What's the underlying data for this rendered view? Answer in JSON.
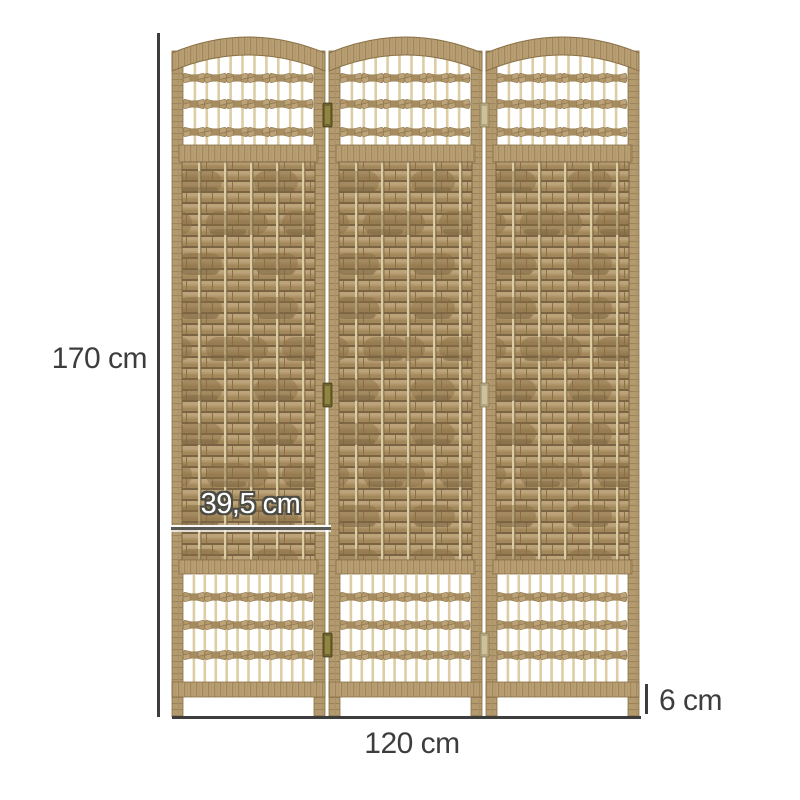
{
  "figure": {
    "type": "product-dimension-diagram",
    "subject": "three-panel woven folding room divider",
    "panel_count": 3,
    "colors": {
      "background": "#ffffff",
      "wood_frame": "#b79d72",
      "wood_dark": "#8a7046",
      "weave_body": "#b09669",
      "weave_gap": "#7a6443",
      "spindle": "#dccda4",
      "hinge_brass": "#6e652e",
      "hinge_tan": "#b3a67f",
      "dimension": "#3d3d3d"
    }
  },
  "labels": {
    "height": "170 cm",
    "panel_width": "39,5 cm",
    "total_width": "120 cm",
    "foot_height": "6 cm"
  }
}
